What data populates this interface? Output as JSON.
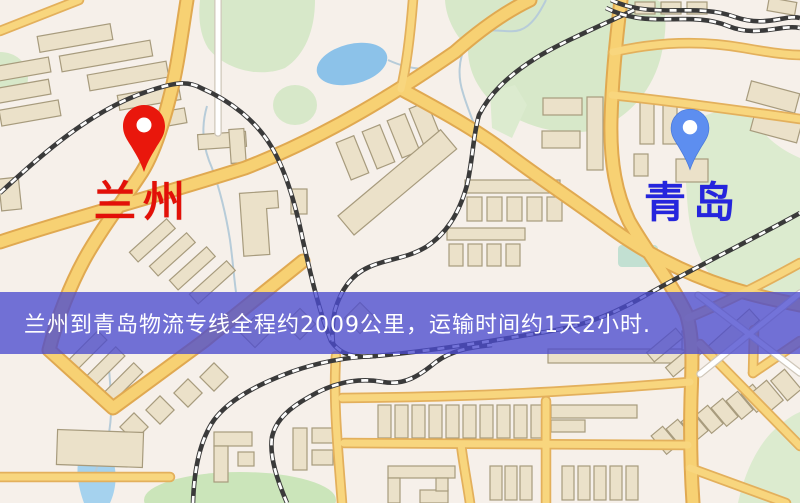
{
  "map": {
    "markers": [
      {
        "id": "lanzhou",
        "label": "兰州",
        "pin_color": "#e9170c",
        "label_color": "#e31008"
      },
      {
        "id": "qingdao",
        "label": "青岛",
        "pin_color": "#5d8ef0",
        "label_color": "#2525dd"
      }
    ],
    "banner": {
      "text": "兰州到青岛物流专线全程约2009公里，运输时间约1天2小时.",
      "text_color": "#ffffff",
      "bg_color": "rgba(75,75,206,0.78)"
    },
    "palette": {
      "background": "#f6f0ea",
      "road_fill": "#f7d173",
      "road_casing": "#e0a951",
      "railway": "#3a3a3a",
      "building_fill": "#ebe1c9",
      "building_stroke": "#a79b7d",
      "green_area": "#d7e8c9",
      "water": "#8cc2e9"
    }
  }
}
